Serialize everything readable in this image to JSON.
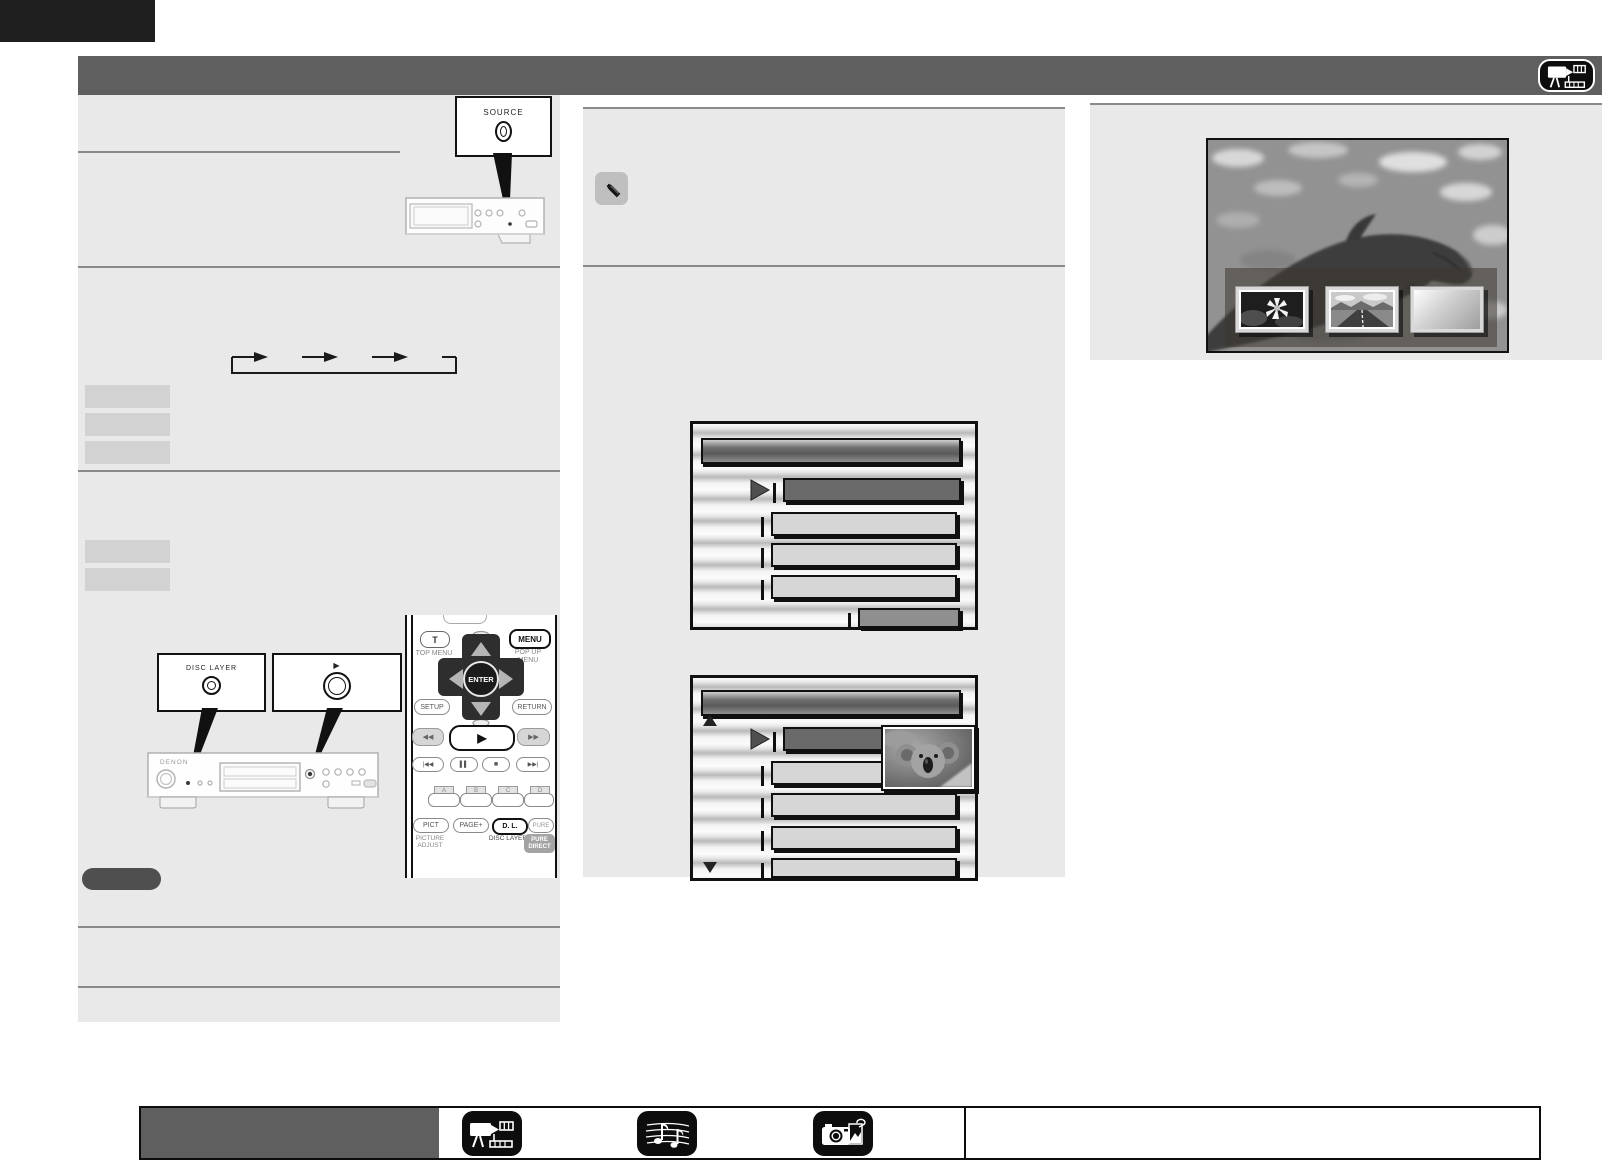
{
  "header": {
    "icon": "movie-camera"
  },
  "callouts": {
    "source": "SOURCE",
    "disc_layer": "DISC LAYER",
    "play": "▶"
  },
  "player": {
    "brand": "DENON"
  },
  "remote": {
    "top_menu_button": "T",
    "top_menu_caption": "TOP MENU",
    "popup_button": "MENU",
    "popup_caption": "POP UP MENU",
    "enter_button": "ENTER",
    "setup_button": "SETUP",
    "return_button": "RETURN",
    "rewind_button": "◀◀",
    "play_button": "▶",
    "fast_forward_button": "▶▶",
    "skip_back_button": "|◀◀",
    "pause_button": "▌▌",
    "stop_button": "■",
    "skip_forward_button": "▶▶|",
    "color_buttons": [
      "A",
      "B",
      "C",
      "D"
    ],
    "pict_button": "PICT",
    "pict_caption": "PICTURE ADJUST",
    "page_button": "PAGE+",
    "disc_layer_button": "D. L.",
    "disc_layer_caption": "DISC LAYER",
    "pure_button": "PURE",
    "pure_caption": "PURE DIRECT"
  },
  "footer": {
    "icons": [
      "movie-camera",
      "music-notes",
      "camera-photos"
    ]
  },
  "colors": {
    "header_bar": "#5f5f5f",
    "page_tab": "#1f1f1f",
    "panel": "#e9e9e9",
    "divider": "#8a8a8a",
    "label_box": "#d2d2d2",
    "note_pill": "#4f4f4f",
    "menu_selected": "#6a6a6a",
    "menu_item": "#d6d6d6",
    "menu_value": "#8f8f8f"
  }
}
